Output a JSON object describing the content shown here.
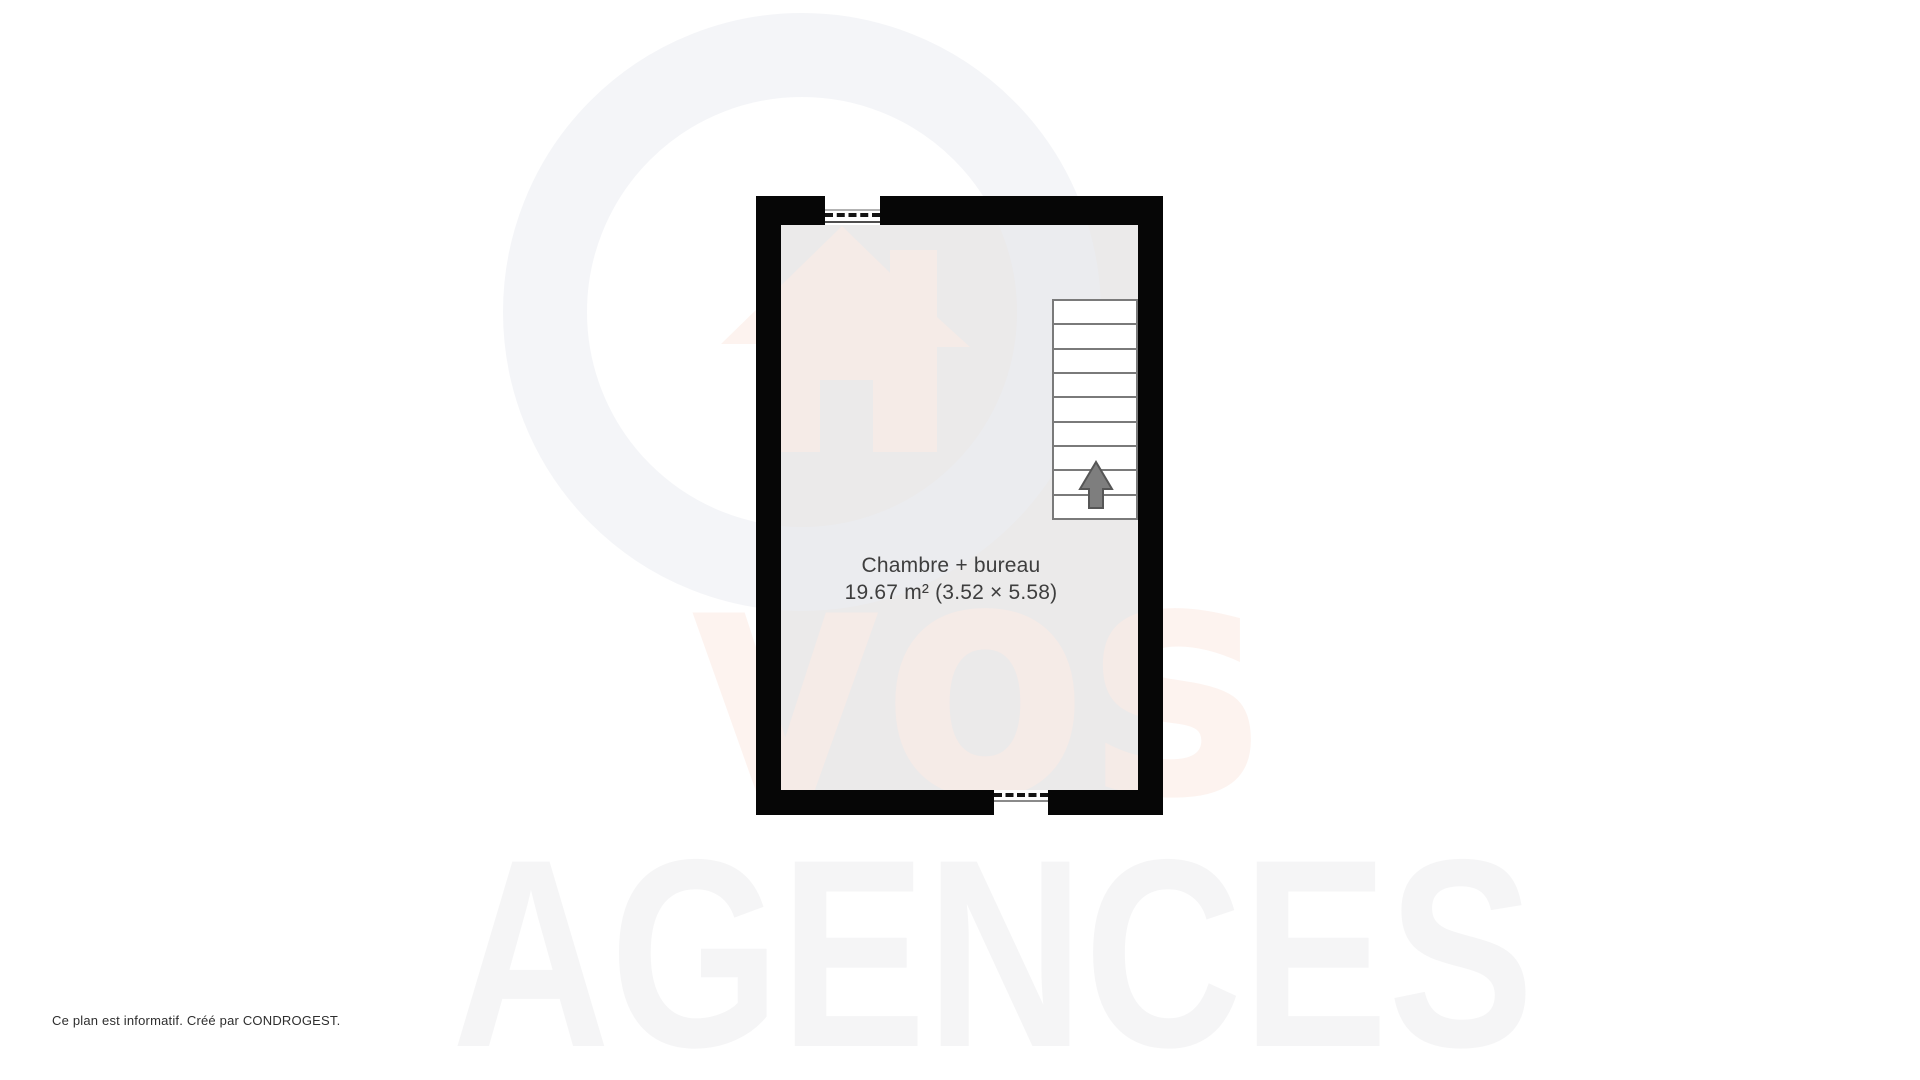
{
  "plan": {
    "room": {
      "name": "Chambre + bureau",
      "area_label": "19.67 m² (3.52 × 5.58)"
    },
    "stairs": {
      "steps": 9,
      "direction": "up"
    },
    "windows": [
      {
        "side": "top"
      },
      {
        "side": "bottom"
      }
    ]
  },
  "watermarks": {
    "brand_text": "vos",
    "agency_text": "AGENCES",
    "logo_icon": "house-in-circle-icon"
  },
  "footer": {
    "note": "Ce plan est informatif. Créé par CONDROGEST."
  },
  "colors": {
    "wall": "#060606",
    "floor": "#ebeaea",
    "stair_outline": "#7a7a7a",
    "arrow_fill": "#7e7e7e",
    "arrow_stroke": "#565656",
    "label_text": "#3e3e3e",
    "footer_text": "#2e2e2e",
    "watermark_pink": "rgba(252,235,228,0.6)",
    "watermark_ring": "rgba(235,236,242,0.55)",
    "watermark_gray": "rgba(240,240,241,0.65)"
  }
}
